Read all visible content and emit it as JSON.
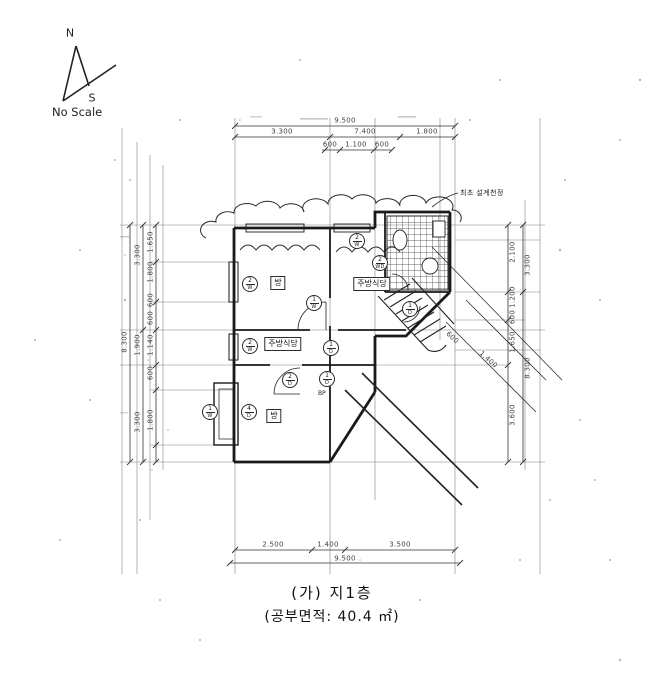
{
  "compass": {
    "north": "N",
    "south": "S",
    "note": "No Scale"
  },
  "caption": {
    "line1": "(가) 지1층",
    "line2": "(공부면적: 40.4 ㎡)"
  },
  "annotation": {
    "revision_note": "최초 설계천정",
    "bp_label": "BP"
  },
  "rooms": {
    "room_upper_left": "방",
    "kitchen_upper": "주방식당",
    "kitchen_middle": "주방식당",
    "room_lower": "방"
  },
  "dimensions": {
    "top": {
      "total": "9.500",
      "seg1": "3.300",
      "seg2": "7.400",
      "seg3": "1.800",
      "sub1": "600",
      "sub2": "1.100",
      "sub3": "600"
    },
    "bottom": {
      "seg1": "2.500",
      "seg2": "1.400",
      "seg3": "3.500",
      "total": "9.500"
    },
    "left": {
      "total": "8.300",
      "mid1": "3.300",
      "mid2": "1.900",
      "mid3": "3.300",
      "in1": "1.650",
      "in2": "1.800",
      "in3": "600",
      "in4": "600",
      "in5": "1.140",
      "in6": "600",
      "in7": "1.800"
    },
    "right": {
      "out1": "3.300",
      "out2": "8.300",
      "in1": "2.100",
      "in2": "1.200",
      "in3": "600",
      "in4": "1.650",
      "in5": "3.600"
    },
    "diag1": "1.400",
    "diag2": "600"
  },
  "tags": [
    {
      "num": "2",
      "code": "W"
    },
    {
      "num": "2",
      "code": "W"
    },
    {
      "num": "2",
      "code": "WD"
    },
    {
      "num": "1",
      "code": "W"
    },
    {
      "num": "1",
      "code": "D"
    },
    {
      "num": "2",
      "code": "W"
    },
    {
      "num": "1",
      "code": "D"
    },
    {
      "num": "1",
      "code": "W"
    },
    {
      "num": "4",
      "code": "D"
    },
    {
      "num": "2",
      "code": "D"
    },
    {
      "num": "1",
      "code": "D"
    }
  ],
  "colors": {
    "ink": "#222222",
    "paper": "#ffffff"
  }
}
